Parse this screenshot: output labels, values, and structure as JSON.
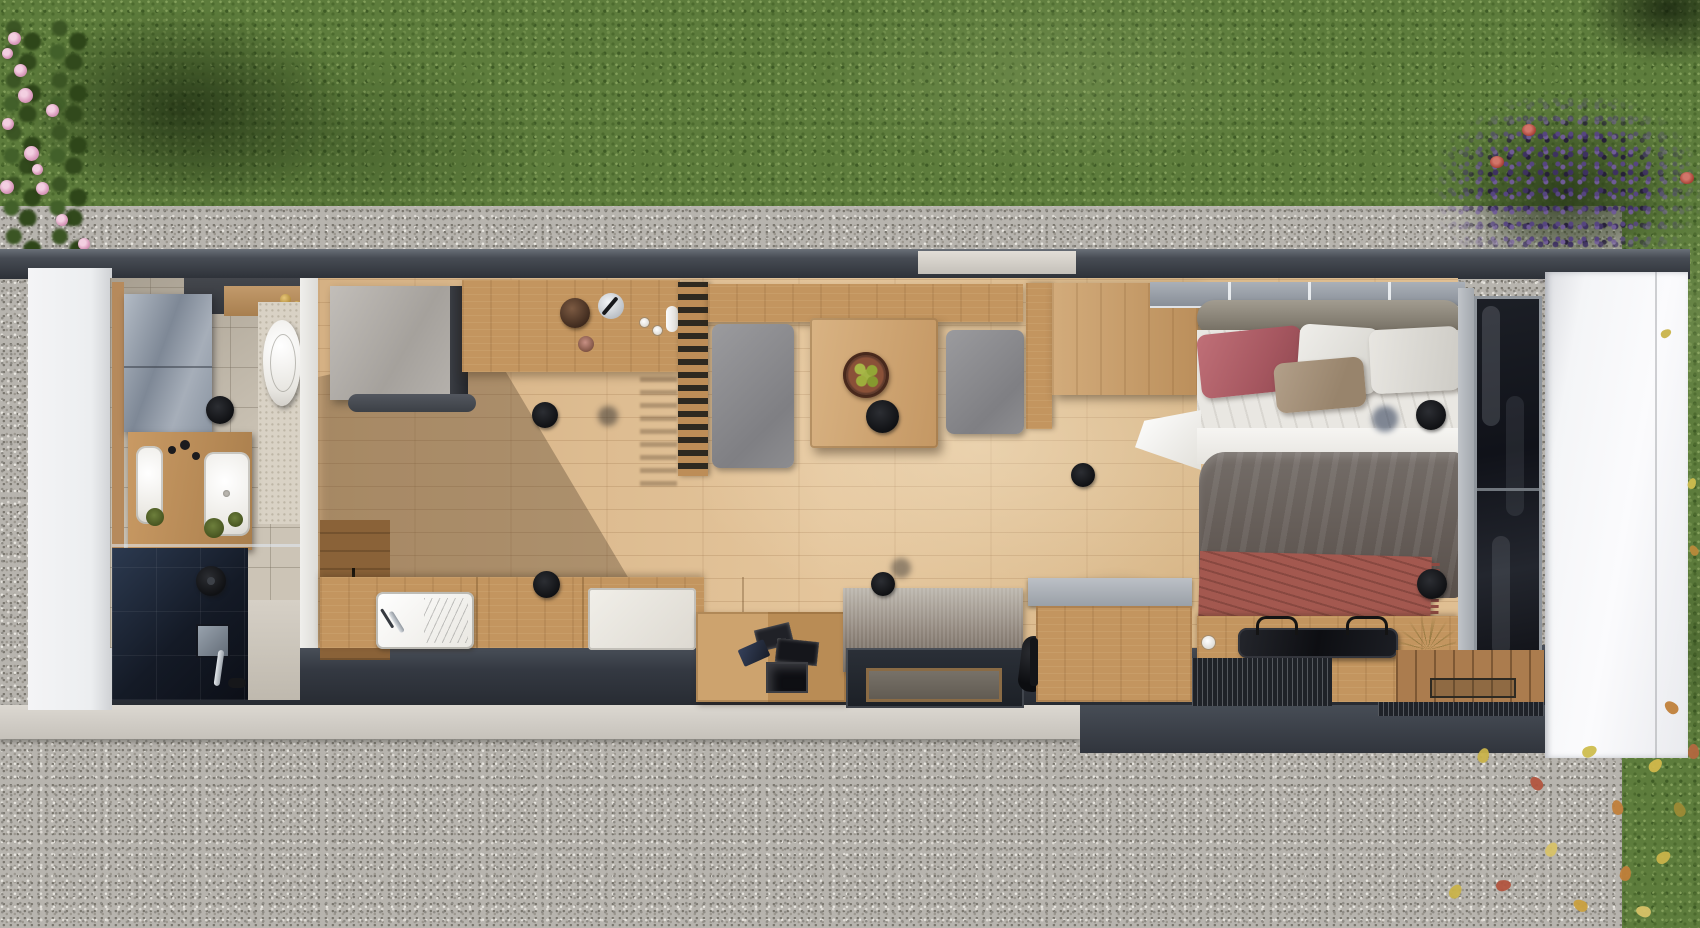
{
  "scene": {
    "title": "Tiny house — top-down 3D floor plan render",
    "view": "aerial top-down cutaway of a long mobile tiny home",
    "canvas": {
      "width": 1700,
      "height": 928
    },
    "visible_text": "none"
  },
  "palette": {
    "grass": "#5d7c3c",
    "gravel": "#b7b4ae",
    "roof_edge": "#3a3f47",
    "wood_floor": "#ddbb8e",
    "wood_furniture": "#c3955f",
    "white_wall": "#f2f3f5",
    "gray_furniture": "#909298",
    "shower_tile": "#1c2330",
    "duvet_gray": "#6b6460",
    "pillow_red": "#b2646a",
    "throw_red": "#a3584f",
    "rug_gray": "#948d83",
    "window_glass": "#15171c",
    "lavender": "#5f4e87",
    "flower_pink": "#db9cbd",
    "leaf_yellow": "#c9b34a"
  },
  "labels": {
    "lawn": "Lawn",
    "lawn_right": "Lawn strip",
    "gravel": "Gravel apron",
    "flower_bed": "Pink flower bed",
    "bush_shadow": "Shrub shadow",
    "lavender": "Lavender bush",
    "leaves": "Fallen autumn leaves",
    "roof_edge": "Roof edge",
    "beam": "Roof beam",
    "skylight": "Skylight strip",
    "left_wall": "Left end wall",
    "right_wall": "Right end wall",
    "fascia": "Base plinth",
    "step": "Concrete step",
    "bathroom_floor": "Bathroom tile floor",
    "mirror_cabinet": "Mirror cabinet",
    "shelf": "Wood shelf with brass fittings",
    "toilet": "Wall-hung toilet",
    "vanity": "Double vanity",
    "basin": "Washbasin",
    "plant": "Potted plant",
    "shower": "Walk-in shower",
    "shower_head": "Black rain shower head",
    "mixer": "Shower mixer",
    "partition_wall": "Partition wall",
    "wood_floor": "Oak plank floor",
    "tall_unit": "Tall gray kitchen unit",
    "counter": "Kitchen counter",
    "coffee_machine": "Coffee machine",
    "kettle": "Kettle",
    "cup": "Cup",
    "slat_partition": "Slatted room divider",
    "upper_cabinet": "Upper cabinet band",
    "bench": "Gray bench seat",
    "dining_table": "Dining table",
    "fruit_bowl": "Bowl of green apples",
    "stool": "Black stool",
    "base_cabinet": "Dark base cabinet",
    "sink": "Kitchen sink with drainboard",
    "cooktop": "White cooktop block",
    "steps": "Storage steps",
    "magazines": "Magazines and pictures",
    "tablet": "Tablet",
    "rug": "Gray area rug",
    "entry_door": "Glass entry door",
    "doormat": "Doormat",
    "bag": "Black bag",
    "clerestory": "Clerestory window band",
    "bolster": "Headboard bolster",
    "bed": "Double bed",
    "pillow_red": "Red pillow",
    "pillow_white": "White pillow",
    "pillow_tan": "Tan pillow",
    "sheet": "White top sheet",
    "duvet": "Gray duvet",
    "throw": "Red throw blanket",
    "wardrobe": "Wardrobe",
    "side_table": "Bedside cube table",
    "bed_bench": "Low sideboard at bed foot",
    "tray": "Black serving tray",
    "twigs": "Dried twigs",
    "dried_plant": "Dried plant",
    "sill": "Window sill wall",
    "picture_window": "Floor-to-ceiling window",
    "deck_boards": "Entry deck boards",
    "deck_mat": "Wooden doormat frame",
    "grate": "Drainage grate",
    "ceiling_light": "Ceiling light",
    "light_shadow": "Light shadow"
  },
  "house": {
    "rooms": [
      {
        "name": "Bathroom",
        "items": [
          "mirror cabinet",
          "wood shelf with brass fittings",
          "wall-hung toilet",
          "double vanity with two basins",
          "plants",
          "walk-in shower with dark tiles",
          "black rain shower head",
          "shower mixer"
        ]
      },
      {
        "name": "Kitchen",
        "items": [
          "tall gray unit",
          "coffee machine",
          "kettle",
          "cups",
          "counter run",
          "sink with drainboard",
          "white cooktop block",
          "dark base cabinet"
        ]
      },
      {
        "name": "Dining / living",
        "items": [
          "slatted room divider",
          "upper cabinet band",
          "two gray bench seats",
          "dining table",
          "bowl of green apples",
          "black stool",
          "storage steps with magazines",
          "gray area rug",
          "glass entry door with doormat"
        ]
      },
      {
        "name": "Bedroom",
        "items": [
          "wardrobe",
          "clerestory window band",
          "headboard bolster",
          "double bed",
          "red / white / tan pillows",
          "gray duvet",
          "red throw blanket",
          "bedside cube table",
          "low sideboard with serving tray",
          "dried plants",
          "floor-to-ceiling window"
        ]
      },
      {
        "name": "Entry deck",
        "items": [
          "deck boards",
          "wooden doormat",
          "drainage grates"
        ]
      }
    ],
    "ceiling_lights_count": 6
  },
  "environment": {
    "ground": "gravel apron around the house",
    "lawn": "grass band at top and strip at right",
    "flora": [
      "pink flowers (top left)",
      "lavender bush with red blooms (top right)",
      "fallen autumn leaves (bottom right)"
    ]
  }
}
